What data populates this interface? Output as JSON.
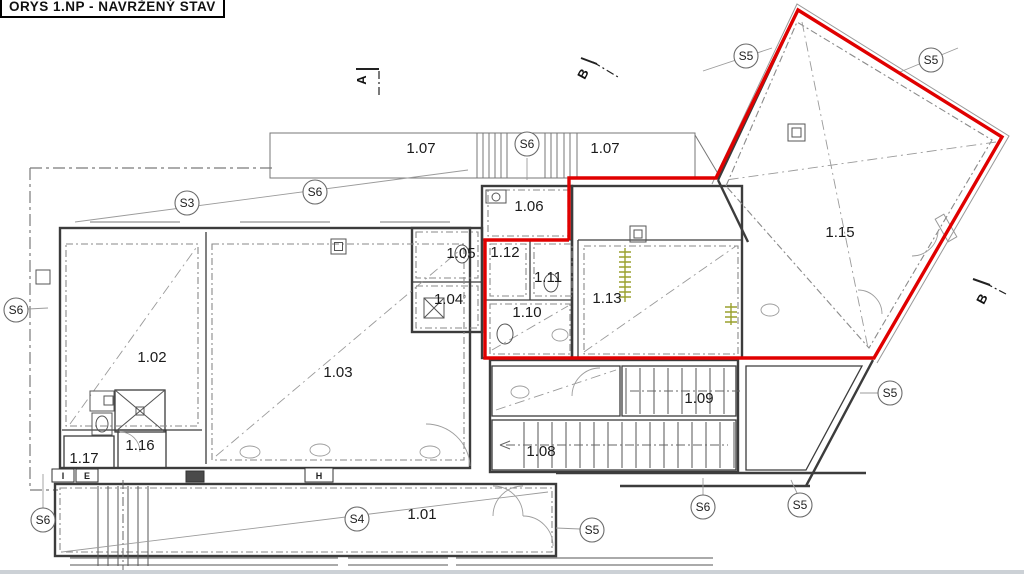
{
  "title_block": {
    "text": "ORYS 1.NP - NAVRŽENÝ STAV"
  },
  "colors": {
    "highlight": "#e00000",
    "wall": "#3c3c3c",
    "hatch": "#9aa12f"
  },
  "red_outline": {
    "points": "569,240 569,178 716,178 798,10 1002,137 874,358 485,358 485,240 569,240"
  },
  "rooms": [
    {
      "label": "1.01",
      "x": 422,
      "y": 519
    },
    {
      "label": "1.02",
      "x": 152,
      "y": 362
    },
    {
      "label": "1.03",
      "x": 338,
      "y": 377
    },
    {
      "label": "1.04",
      "x": 450,
      "y": 304,
      "sup": "▫"
    },
    {
      "label": "1.05",
      "x": 461,
      "y": 258
    },
    {
      "label": "1.06",
      "x": 529,
      "y": 211
    },
    {
      "label": "1.07",
      "x": 421,
      "y": 153
    },
    {
      "label": "1.07",
      "x": 605,
      "y": 153
    },
    {
      "label": "1.08",
      "x": 541,
      "y": 456
    },
    {
      "label": "1.09",
      "x": 699,
      "y": 403
    },
    {
      "label": "1.10",
      "x": 527,
      "y": 317
    },
    {
      "label": "1.11",
      "x": 548,
      "y": 282
    },
    {
      "label": "1.12",
      "x": 505,
      "y": 257
    },
    {
      "label": "1.13",
      "x": 607,
      "y": 303
    },
    {
      "label": "1.15",
      "x": 840,
      "y": 237
    },
    {
      "label": "1.16",
      "x": 140,
      "y": 450
    },
    {
      "label": "1.17",
      "x": 84,
      "y": 463
    }
  ],
  "section_bubbles": [
    {
      "label": "S3",
      "x": 187,
      "y": 203
    },
    {
      "label": "S6",
      "x": 315,
      "y": 192
    },
    {
      "label": "S6",
      "x": 527,
      "y": 144
    },
    {
      "label": "S6",
      "x": 16,
      "y": 310
    },
    {
      "label": "S6",
      "x": 43,
      "y": 520
    },
    {
      "label": "S4",
      "x": 357,
      "y": 519
    },
    {
      "label": "S5",
      "x": 592,
      "y": 530
    },
    {
      "label": "S6",
      "x": 703,
      "y": 507
    },
    {
      "label": "S5",
      "x": 800,
      "y": 505
    },
    {
      "label": "S5",
      "x": 890,
      "y": 393
    },
    {
      "label": "S5",
      "x": 746,
      "y": 56
    },
    {
      "label": "S5",
      "x": 931,
      "y": 60
    }
  ],
  "cut_markers": [
    {
      "label": "A",
      "x": 366,
      "y": 80,
      "rot": -90,
      "solid": [
        356,
        69,
        379,
        69
      ],
      "dash": [
        379,
        71,
        379,
        97
      ]
    },
    {
      "label": "B",
      "x": 587,
      "y": 76,
      "rot": -62,
      "solid": [
        581,
        58,
        597,
        64
      ],
      "dash": [
        593,
        62,
        618,
        77
      ]
    },
    {
      "label": "B",
      "x": 986,
      "y": 301,
      "rot": -62,
      "solid": [
        973,
        279,
        990,
        285
      ],
      "dash": [
        985,
        283,
        1006,
        294
      ]
    }
  ],
  "wall_tags": [
    {
      "text": "I",
      "x": 52,
      "y": 469,
      "w": 22,
      "h": 13,
      "dark": false
    },
    {
      "text": "E",
      "x": 76,
      "y": 469,
      "w": 22,
      "h": 13,
      "dark": false
    },
    {
      "text": "",
      "x": 186,
      "y": 471,
      "w": 18,
      "h": 11,
      "dark": true
    },
    {
      "text": "H",
      "x": 305,
      "y": 468,
      "w": 28,
      "h": 14,
      "dark": false
    }
  ]
}
